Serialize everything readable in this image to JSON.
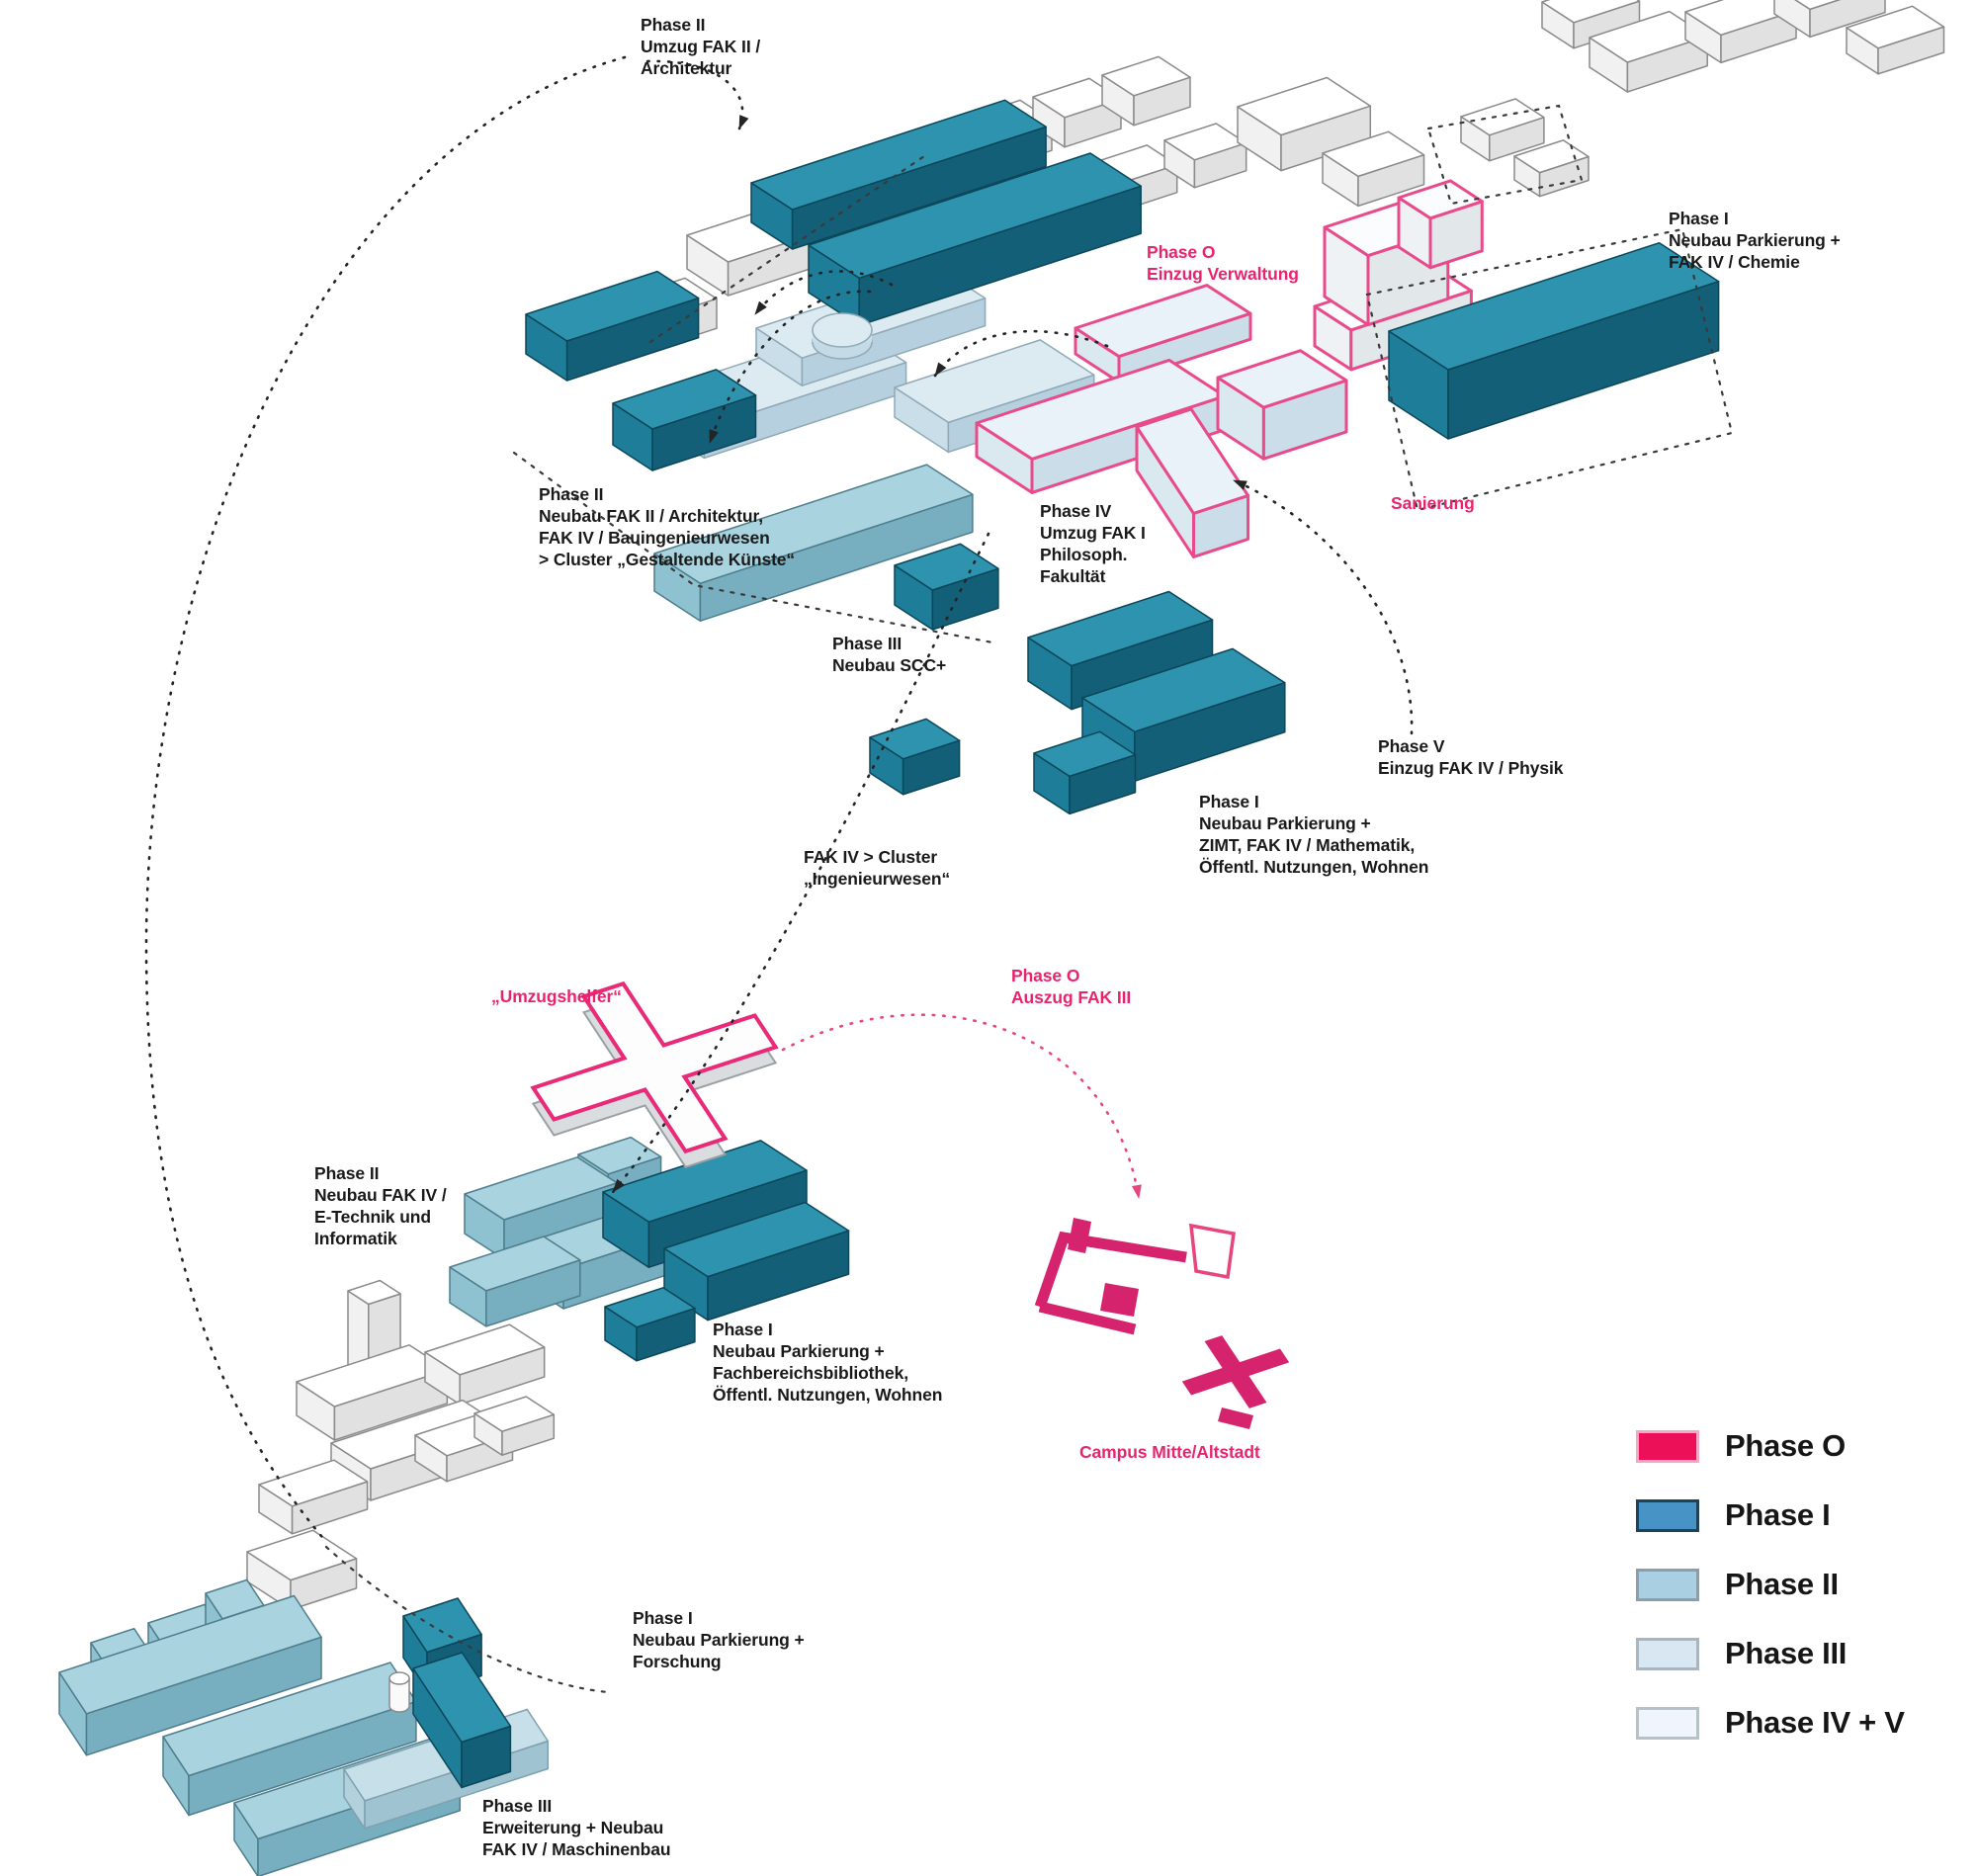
{
  "diagram": {
    "annotations": [
      {
        "id": "phase2-umzug-architektur",
        "tone": "black",
        "text": "Phase II\nUmzug FAK II /\nArchitektur"
      },
      {
        "id": "phase0-einzug-verwaltung",
        "tone": "pink",
        "text": "Phase O\nEinzug Verwaltung"
      },
      {
        "id": "phase1-chemie",
        "tone": "black",
        "text": "Phase I\nNeubau Parkierung +\nFAK IV / Chemie"
      },
      {
        "id": "phase2-neubau-fak2",
        "tone": "black",
        "text": "Phase II\nNeubau FAK II / Architektur,\nFAK IV / Bauingenieurwesen\n> Cluster „Gestaltende Künste“"
      },
      {
        "id": "phase4-umzug-fak1",
        "tone": "black",
        "text": "Phase IV\nUmzug FAK I\nPhilosoph.\nFakultät"
      },
      {
        "id": "sanierung",
        "tone": "pink",
        "text": "Sanierung"
      },
      {
        "id": "phase3-neubau-scc",
        "tone": "black",
        "text": "Phase III\nNeubau SCC+"
      },
      {
        "id": "phase5-einzug-physik",
        "tone": "black",
        "text": "Phase V\nEinzug FAK IV / Physik"
      },
      {
        "id": "phase1-zimt",
        "tone": "black",
        "text": "Phase I\nNeubau Parkierung +\nZIMT, FAK IV / Mathematik,\nÖffentl. Nutzungen, Wohnen"
      },
      {
        "id": "fak4-cluster-ingenieurwesen",
        "tone": "black",
        "text": "FAK IV > Cluster\n„Ingenieurwesen“"
      },
      {
        "id": "umzugshelfer",
        "tone": "pink",
        "text": "„Umzugshelfer“"
      },
      {
        "id": "phase0-auszug-fak3",
        "tone": "pink",
        "text": "Phase O\nAuszug FAK III"
      },
      {
        "id": "phase2-etechnik",
        "tone": "black",
        "text": "Phase II\nNeubau FAK IV /\nE-Technik und\nInformatik"
      },
      {
        "id": "phase1-bibliothek",
        "tone": "black",
        "text": "Phase I\nNeubau Parkierung +\nFachbereichsbibliothek,\nÖffentl. Nutzungen, Wohnen"
      },
      {
        "id": "campus-mitte",
        "tone": "pink",
        "text": "Campus Mitte/Altstadt"
      },
      {
        "id": "phase1-forschung",
        "tone": "black",
        "text": "Phase I\nNeubau Parkierung +\nForschung"
      },
      {
        "id": "phase3-maschinenbau",
        "tone": "black",
        "text": "Phase III\nErweiterung + Neubau\nFAK IV / Maschinenbau"
      }
    ],
    "legend": [
      {
        "label": "Phase O",
        "fill": "#ec1059",
        "border": "#f5a9c7"
      },
      {
        "label": "Phase I",
        "fill": "#4793c5",
        "border": "#1f4258"
      },
      {
        "label": "Phase II",
        "fill": "#a9cfe3",
        "border": "#8d9ea8"
      },
      {
        "label": "Phase III",
        "fill": "#d9e7f2",
        "border": "#a9b6c0"
      },
      {
        "label": "Phase IV + V",
        "fill": "#eff5fa",
        "border": "#b7c1c8"
      }
    ],
    "colors": {
      "phase_o_accent": "#e8246f",
      "phase1_building": "#2e93ae",
      "phase2_building": "#a8d3df",
      "phase3_building": "#dceaf2",
      "phase45_building": "#e9f2f8",
      "existing_building": "#ffffff",
      "annotation_text": "#1a1a1a"
    }
  }
}
